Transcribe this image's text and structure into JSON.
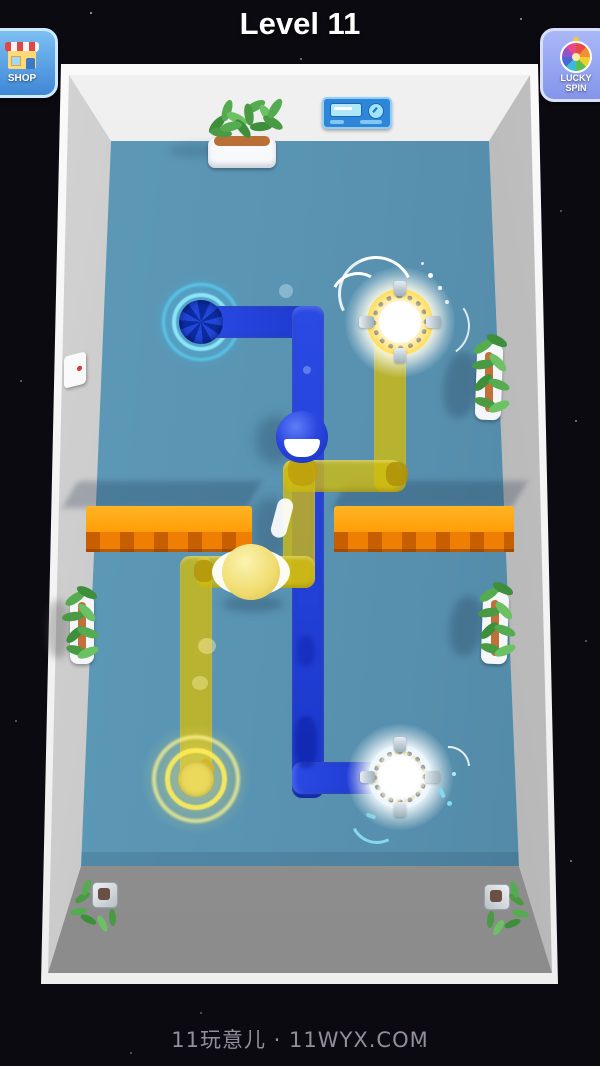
{
  "header": {
    "title": "Level 11"
  },
  "toolbar": {
    "shop": {
      "label": "SHOP",
      "icon": "storefront-icon"
    },
    "lucky_spin": {
      "label": "LUCKY SPIN",
      "icon": "prize-wheel-icon"
    }
  },
  "footer": {
    "watermark": "11玩意儿 · 11WYX.COM"
  },
  "palette": {
    "background": "#0b0a10",
    "floor": "#5894b3",
    "wall_top": "#ededed",
    "wall_side": "#b5b5b5",
    "frame": "#f8f8f8",
    "pipe_blue": "#1d3ed6",
    "pipe_yellow": "#d2bc14",
    "barrier_top": "#ffa714",
    "barrier_front": "#ef7f02",
    "glow_cyan": "#35c8ff",
    "glow_yellow": "#ffe84a",
    "shop_button_blue": "#4a93dd",
    "lucky_spin_violet": "#8fa3f2"
  },
  "scene": {
    "entities": [
      {
        "name": "blue-drain",
        "position": "top-left",
        "icon": "cyan-glow-rings-drain"
      },
      {
        "name": "yellow-energy-portal",
        "position": "top-right",
        "icon": "glowing-hazard-ring-portal"
      },
      {
        "name": "yellow-drain",
        "position": "bottom-left",
        "icon": "yellow-glow-rings-drain"
      },
      {
        "name": "blue-energy-portal",
        "position": "bottom-right",
        "icon": "glowing-hazard-ring-portal"
      },
      {
        "name": "blue-character",
        "icon": "blue-ball-smile"
      },
      {
        "name": "yellow-character",
        "icon": "yellow-ball"
      },
      {
        "name": "orange-barrier-left"
      },
      {
        "name": "orange-barrier-right"
      },
      {
        "name": "planter-top"
      },
      {
        "name": "planter-left"
      },
      {
        "name": "planter-right-upper"
      },
      {
        "name": "planter-right-lower"
      },
      {
        "name": "corner-plant-bottom-left"
      },
      {
        "name": "corner-plant-bottom-right"
      },
      {
        "name": "control-panel"
      },
      {
        "name": "wall-switch"
      }
    ]
  }
}
